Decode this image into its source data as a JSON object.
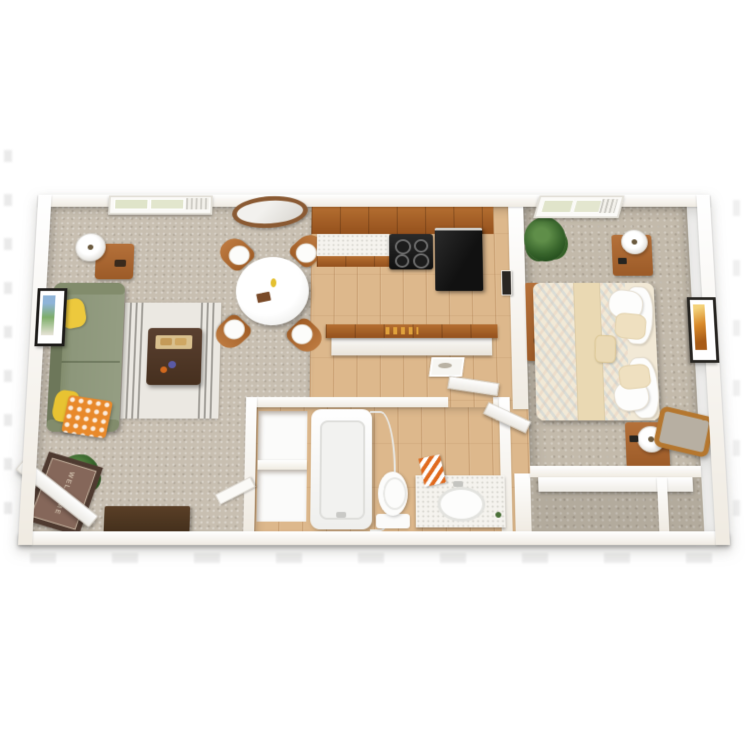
{
  "scene": {
    "description": "3D top-down render of a one-bedroom apartment floor plan on a white background",
    "doormat_text": "WELCOME",
    "rooms": [
      {
        "name": "living-room",
        "floor": "beige carpet",
        "furniture": [
          "green sofa with yellow pillows and orange patterned throw",
          "striped area rug",
          "dark wood coffee table with tray",
          "round white dining table",
          "four wood dining chairs",
          "floor lamp",
          "wood side table",
          "framed wall art",
          "oval wall mirror",
          "window with AC unit",
          "potted plant",
          "media console",
          "welcome doormat",
          "open entry door"
        ]
      },
      {
        "name": "kitchen",
        "floor": "light wood",
        "furniture": [
          "wood upper cabinets",
          "white countertop",
          "black range with four burners",
          "black refrigerator",
          "breakfast-bar peninsula with wood top",
          "small framed print"
        ]
      },
      {
        "name": "hallway",
        "floor": "light wood",
        "furniture": [
          "small wall frame"
        ]
      },
      {
        "name": "bathroom",
        "floor": "light wood",
        "furniture": [
          "bathtub with curved shower rod",
          "toilet",
          "vanity with oval sink",
          "orange striped towels",
          "linen closet shelves",
          "bathroom door"
        ]
      },
      {
        "name": "bedroom",
        "floor": "beige carpet",
        "furniture": [
          "bed with cream patterned bedding and pillows",
          "two wood nightstands",
          "two white table lamps",
          "wood dresser",
          "framed orange wall art",
          "wood framed mirror",
          "closet with shelf",
          "window with blinds",
          "potted plant",
          "bedroom door"
        ]
      }
    ],
    "colors": {
      "wall": "#f5f1ea",
      "carpet": "#c8bfb1",
      "wood_floor": "#ddb88c",
      "cabinet": "#a85d26",
      "sofa": "#8d977b",
      "pillow_yellow": "#edc93d",
      "throw_orange": "#e8892b",
      "appliance_black": "#161616",
      "bedding": "#f1e7d4",
      "accent_wood": "#ad6a32",
      "rug": "#ebe8e2",
      "doormat": "#7b5f4f",
      "art_orange": "#d98a2b"
    }
  }
}
